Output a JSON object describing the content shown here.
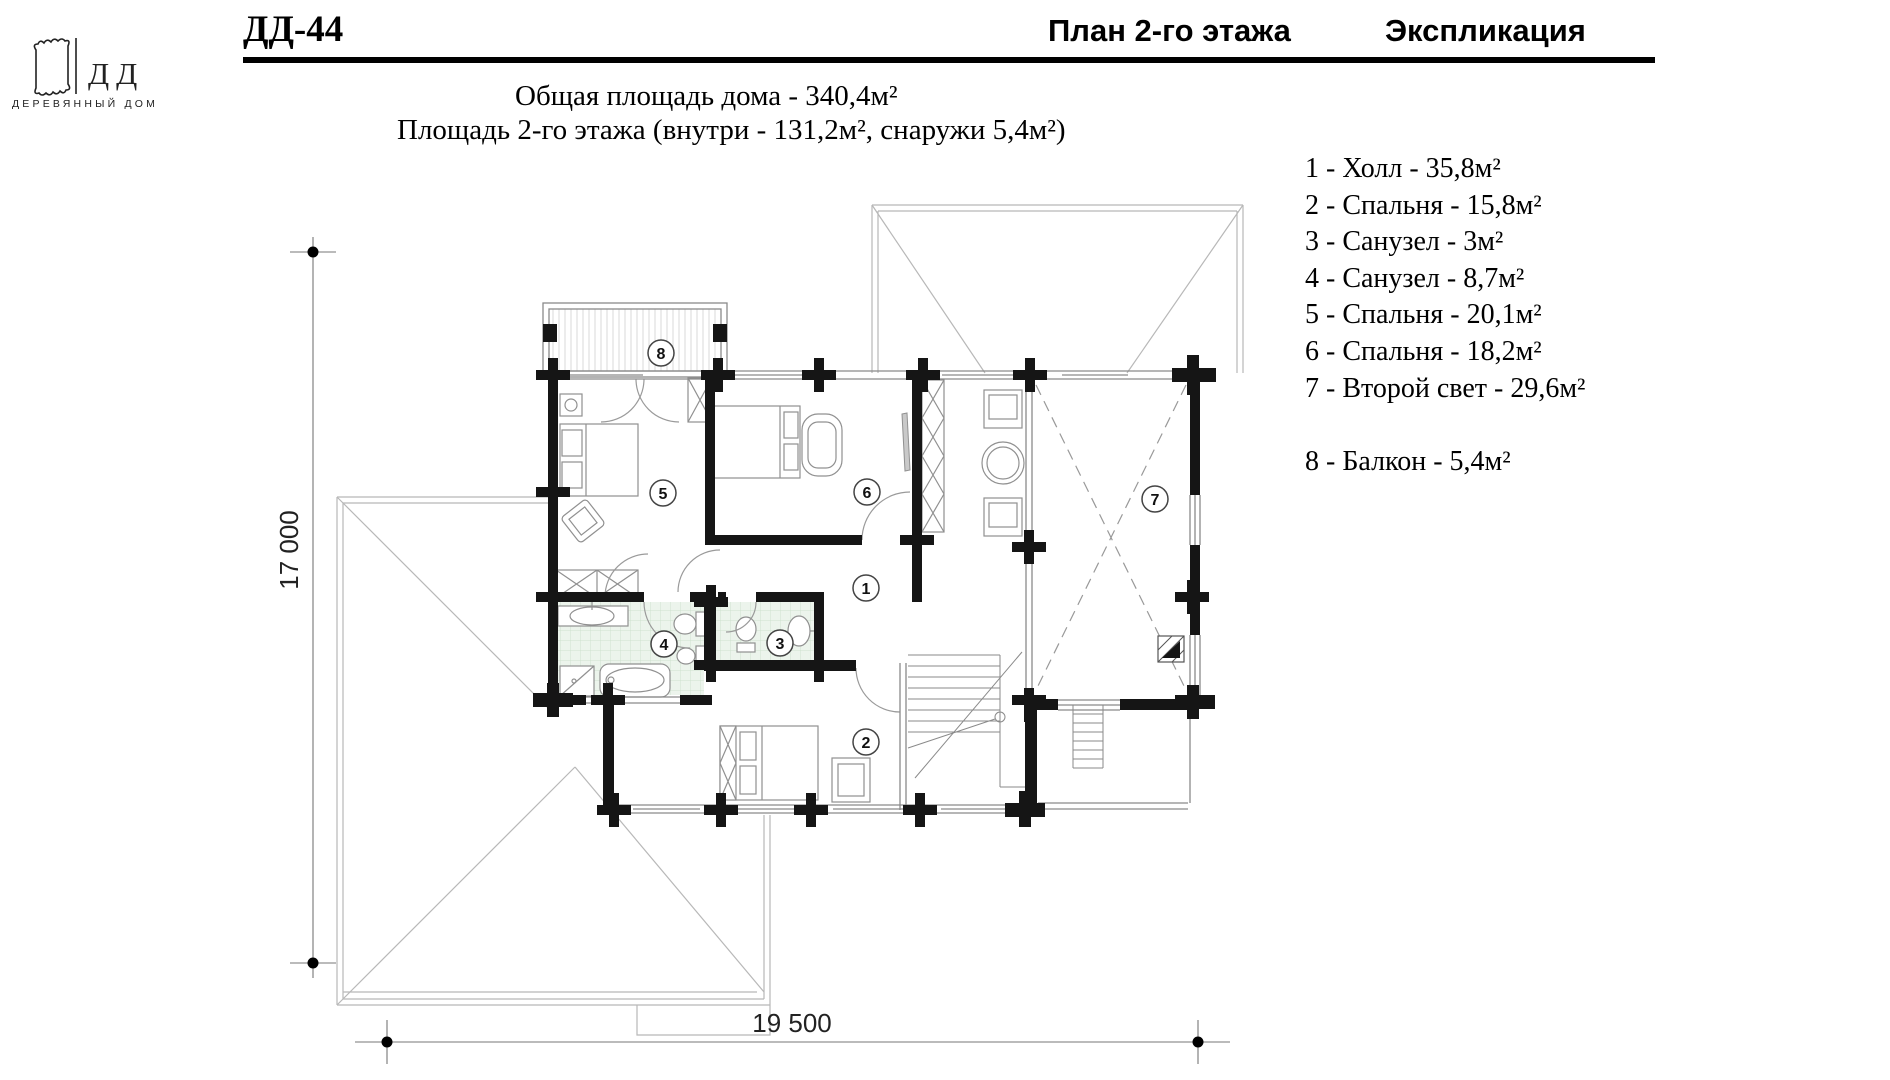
{
  "logo": {
    "icon": "log-end-icon",
    "letters": "ДД",
    "caption": "ДЕРЕВЯННЫЙ ДОМ"
  },
  "header": {
    "project_code": "ДД-44",
    "plan_title": "План 2-го этажа",
    "legend_title": "Экспликация"
  },
  "summary": {
    "total_area": "Общая площадь дома - 340,4м²",
    "floor_area": "Площадь 2-го этажа (внутри - 131,2м², снаружи 5,4м²)"
  },
  "explication": {
    "items": [
      {
        "label": "1 - Холл - 35,8м²"
      },
      {
        "label": "2 - Спальня - 15,8м²"
      },
      {
        "label": "3 - Санузел - 3м²"
      },
      {
        "label": "4 - Санузел - 8,7м²"
      },
      {
        "label": "5 - Спальня - 20,1м²"
      },
      {
        "label": "6 - Спальня - 18,2м²"
      },
      {
        "label": "7 - Второй свет - 29,6м²"
      },
      {
        "label": "8 - Балкон - 5,4м²"
      }
    ]
  },
  "plan": {
    "room_markers": [
      {
        "number": "1",
        "name": "Холл",
        "area": "35,8м²"
      },
      {
        "number": "2",
        "name": "Спальня",
        "area": "15,8м²"
      },
      {
        "number": "3",
        "name": "Санузел",
        "area": "3м²"
      },
      {
        "number": "4",
        "name": "Санузел",
        "area": "8,7м²"
      },
      {
        "number": "5",
        "name": "Спальня",
        "area": "20,1м²"
      },
      {
        "number": "6",
        "name": "Спальня",
        "area": "18,2м²"
      },
      {
        "number": "7",
        "name": "Второй свет",
        "area": "29,6м²"
      },
      {
        "number": "8",
        "name": "Балкон",
        "area": "5,4м²"
      }
    ],
    "dimensions": {
      "height_label": "17 000",
      "width_label": "19 500"
    }
  },
  "colors": {
    "wall": "#151515",
    "bath_tile": "#ecf4ec",
    "roof_line": "#b8b8b8",
    "text": "#000000"
  }
}
